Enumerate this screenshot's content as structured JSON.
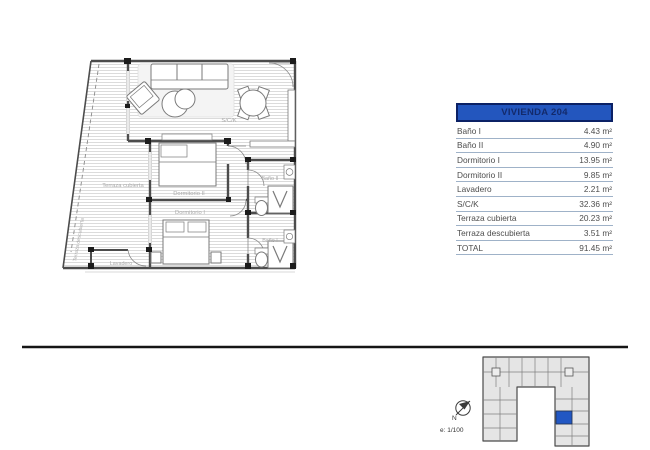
{
  "floor_plan": {
    "labels": {
      "sck": "S/C/K",
      "dormitorio_ii": "Dormitorio II",
      "dormitorio_i": "Dormitorio I",
      "bano_ii": "Baño II",
      "bano_i": "Baño I",
      "lavadero": "Lavadero",
      "terraza_cubierta": "Terraza cubierta",
      "terraza_descubierta": "Terraza descubierta"
    }
  },
  "area_table": {
    "title": "VIVIENDA 204",
    "header_bg": "#2356be",
    "rows": [
      {
        "label": "Baño I",
        "value": "4.43 m²"
      },
      {
        "label": "Baño II",
        "value": "4.90 m²"
      },
      {
        "label": "Dormitorio I",
        "value": "13.95 m²"
      },
      {
        "label": "Dormitorio II",
        "value": "9.85 m²"
      },
      {
        "label": "Lavadero",
        "value": "2.21 m²"
      },
      {
        "label": "S/C/K",
        "value": "32.36 m²"
      },
      {
        "label": "Terraza cubierta",
        "value": "20.23 m²"
      },
      {
        "label": "Terraza descubierta",
        "value": "3.51 m²"
      },
      {
        "label": "TOTAL",
        "value": "91.45 m²"
      }
    ]
  },
  "footer": {
    "north_label": "N",
    "scale_label": "e: 1/100"
  },
  "site_plan": {
    "highlight_color": "#2257c3"
  }
}
